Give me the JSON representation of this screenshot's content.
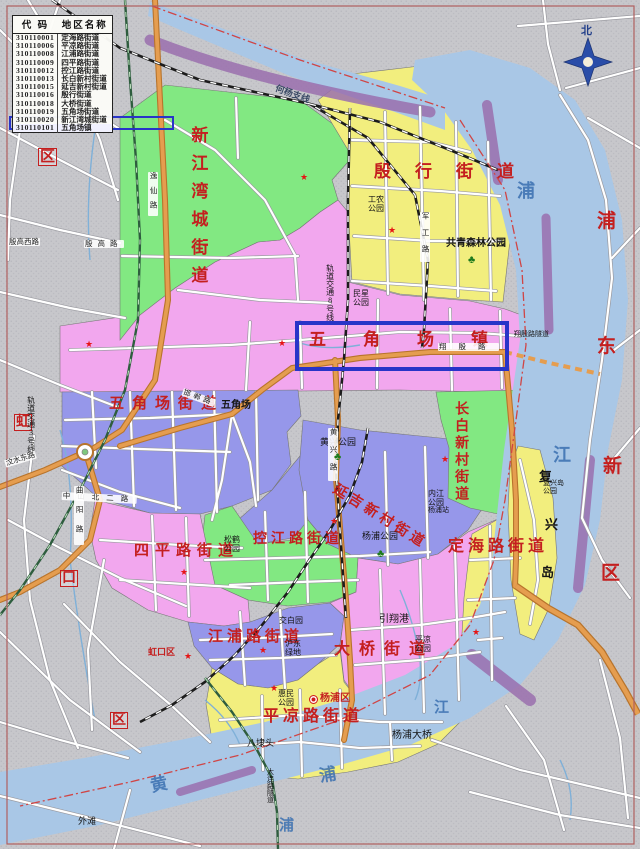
{
  "legend": {
    "headers": [
      "代 码",
      "地区名称"
    ],
    "rows": [
      [
        "310110001",
        "定海路街道"
      ],
      [
        "310110006",
        "平凉路街道"
      ],
      [
        "310110008",
        "江浦路街道"
      ],
      [
        "310110009",
        "四平路街道"
      ],
      [
        "310110012",
        "控江路街道"
      ],
      [
        "310110013",
        "长白新村街道"
      ],
      [
        "310110015",
        "延吉新村街道"
      ],
      [
        "310110016",
        "殷行街道"
      ],
      [
        "310110018",
        "大桥街道"
      ],
      [
        "310110019",
        "五角场街道"
      ],
      [
        "310110020",
        "新江湾城街道"
      ],
      [
        "310110101",
        "五角场镇"
      ]
    ],
    "highlighted_row_index": 11,
    "highlighted_row_value": "310110101 五角场镇"
  },
  "compass": {
    "north_label": "北"
  },
  "map": {
    "colors": {
      "outside_gray": "#c6c6ca",
      "region_pink": "#f2a7ee",
      "region_green": "#82e882",
      "region_yellow": "#f2ee7e",
      "region_blue": "#9697ea",
      "river_blue": "#a9c7e6",
      "orange_road": "#e59d4f",
      "purple_bank": "#9a6fae",
      "frame_red": "#b06060",
      "boundary_red": "#d04545",
      "metro_green": "#2e5d3e",
      "highlight_blue": "#2834c8",
      "red_label": "#c41f1f"
    },
    "labels": [
      {
        "n": "label-xinjiangwancheng-subdistrict",
        "t": "新江湾城街道",
        "x": 188,
        "y": 126,
        "c": "c-r",
        "fs": 17,
        "ls": 11,
        "v": true
      },
      {
        "n": "label-yinhang-subdistrict",
        "t": "殷行街道",
        "x": 374,
        "y": 163,
        "c": "c-r",
        "fs": 17,
        "ls": 24
      },
      {
        "n": "label-wujiaochang-town",
        "t": "五角场镇",
        "x": 309,
        "y": 331,
        "c": "c-r",
        "fs": 17,
        "ls": 37
      },
      {
        "n": "label-wujiaochang-subdistrict",
        "t": "五角场街道",
        "x": 109,
        "y": 396,
        "c": "c-r",
        "fs": 15,
        "ls": 8
      },
      {
        "n": "label-changbai-subdistrict",
        "t": "长白新村街道",
        "x": 453,
        "y": 401,
        "c": "c-r",
        "fs": 14,
        "ls": 3,
        "v": true
      },
      {
        "n": "label-yanji-subdistrict",
        "t": "延吉新村街道",
        "x": 338,
        "y": 482,
        "c": "c-r",
        "fs": 14,
        "ls": 4,
        "rot": 32
      },
      {
        "n": "label-kongjiang-subdistrict",
        "t": "控江路街道",
        "x": 253,
        "y": 532,
        "c": "c-r",
        "fs": 14,
        "ls": 4
      },
      {
        "n": "label-siping-subdistrict",
        "t": "四平路街道",
        "x": 134,
        "y": 543,
        "c": "c-r",
        "fs": 15,
        "ls": 6
      },
      {
        "n": "label-jiangpu-subdistrict",
        "t": "江浦路街道",
        "x": 208,
        "y": 629,
        "c": "c-r",
        "fs": 15,
        "ls": 4
      },
      {
        "n": "label-daqiao-subdistrict",
        "t": "大桥街道",
        "x": 334,
        "y": 641,
        "c": "c-r",
        "fs": 16,
        "ls": 9
      },
      {
        "n": "label-pingliang-subdistrict",
        "t": "平凉路街道",
        "x": 263,
        "y": 708,
        "c": "c-r",
        "fs": 16,
        "ls": 4
      },
      {
        "n": "label-dinghai-subdistrict",
        "t": "定海路街道",
        "x": 448,
        "y": 538,
        "c": "c-r",
        "fs": 16,
        "ls": 4
      },
      {
        "n": "label-pudong-pu",
        "t": "浦",
        "x": 597,
        "y": 212,
        "c": "c-r",
        "fs": 19
      },
      {
        "n": "label-pudong-dong",
        "t": "东",
        "x": 597,
        "y": 337,
        "c": "c-r",
        "fs": 19
      },
      {
        "n": "label-pudong-xin",
        "t": "新",
        "x": 603,
        "y": 457,
        "c": "c-r",
        "fs": 19
      },
      {
        "n": "label-pudong-qu",
        "t": "区",
        "x": 601,
        "y": 564,
        "c": "c-r",
        "fs": 19
      },
      {
        "n": "label-hongkou-hong",
        "t": "虹",
        "x": 14,
        "y": 414,
        "c": "c-r",
        "fs": 14,
        "box": true
      },
      {
        "n": "label-hongkou-kou",
        "t": "口",
        "x": 60,
        "y": 570,
        "c": "c-r",
        "fs": 14,
        "box": true
      },
      {
        "n": "label-hongkou-qu",
        "t": "区",
        "x": 110,
        "y": 712,
        "c": "c-r",
        "fs": 14,
        "box": true
      },
      {
        "n": "label-baoshan-qu",
        "t": "区",
        "x": 38,
        "y": 148,
        "c": "c-r",
        "fs": 15,
        "box": true
      },
      {
        "n": "label-hongkou-gov",
        "t": "虹口区",
        "x": 148,
        "y": 648,
        "c": "c-r",
        "fs": 9
      },
      {
        "n": "label-yangpu-gov",
        "t": "杨浦区",
        "x": 320,
        "y": 694,
        "c": "c-r",
        "fs": 10
      },
      {
        "n": "label-gongqing-forest-park",
        "t": "共青森林公园",
        "x": 446,
        "y": 239,
        "c": "c-kb",
        "fs": 10
      },
      {
        "n": "label-gongnong-park",
        "t": "工农\n公园",
        "x": 368,
        "y": 196,
        "c": "c-k",
        "fs": 8
      },
      {
        "n": "label-minxing-park",
        "t": "民星\n公园",
        "x": 353,
        "y": 290,
        "c": "c-k",
        "fs": 8
      },
      {
        "n": "label-huangxing-park",
        "t": "黄兴公园",
        "x": 320,
        "y": 438,
        "c": "c-k",
        "fs": 9
      },
      {
        "n": "label-yangpu-park",
        "t": "杨浦公园",
        "x": 362,
        "y": 532,
        "c": "c-k",
        "fs": 9
      },
      {
        "n": "label-neijiang-park",
        "t": "内江\n公园",
        "x": 428,
        "y": 490,
        "c": "c-k",
        "fs": 8
      },
      {
        "n": "label-songhe-park",
        "t": "松鹤\n公园",
        "x": 224,
        "y": 536,
        "c": "c-k",
        "fs": 8
      },
      {
        "n": "label-pingliang-park",
        "t": "平凉\n公园",
        "x": 415,
        "y": 636,
        "c": "c-k",
        "fs": 8
      },
      {
        "n": "label-huimin-park",
        "t": "惠民\n公园",
        "x": 278,
        "y": 690,
        "c": "c-k",
        "fs": 8
      },
      {
        "n": "label-yinxiang-port",
        "t": "引翔港",
        "x": 379,
        "y": 615,
        "c": "c-k",
        "fs": 10
      },
      {
        "n": "label-badaitou",
        "t": "八埭头",
        "x": 247,
        "y": 739,
        "c": "c-k",
        "fs": 9
      },
      {
        "n": "label-hudong-green",
        "t": "沪东\n绿地",
        "x": 285,
        "y": 640,
        "c": "c-k",
        "fs": 8
      },
      {
        "n": "label-jiaobai-garden",
        "t": "交白园",
        "x": 279,
        "y": 617,
        "c": "c-k",
        "fs": 8
      },
      {
        "n": "label-wujiaochang-place",
        "t": "五角场",
        "x": 221,
        "y": 401,
        "c": "c-kb",
        "fs": 10
      },
      {
        "n": "label-yangpu-bridge",
        "t": "杨浦大桥",
        "x": 392,
        "y": 731,
        "c": "c-k",
        "fs": 10
      },
      {
        "n": "label-yangpu-station",
        "t": "杨浦站",
        "x": 428,
        "y": 507,
        "c": "c-k",
        "fs": 7
      },
      {
        "n": "label-fuxing-island-park",
        "t": "复兴岛\n公园",
        "x": 543,
        "y": 480,
        "c": "c-k",
        "fs": 7
      },
      {
        "n": "label-waitan",
        "t": "外滩",
        "x": 78,
        "y": 817,
        "c": "c-k",
        "fs": 9
      },
      {
        "n": "label-fuxing-fu",
        "t": "复",
        "x": 539,
        "y": 470,
        "c": "c-kb",
        "fs": 13
      },
      {
        "n": "label-fuxing-xing",
        "t": "兴",
        "x": 545,
        "y": 518,
        "c": "c-kb",
        "fs": 13
      },
      {
        "n": "label-fuxing-dao",
        "t": "岛",
        "x": 541,
        "y": 566,
        "c": "c-kb",
        "fs": 13
      },
      {
        "n": "label-xiangyin-tunnel",
        "t": "翔殷路隧道",
        "x": 514,
        "y": 331,
        "c": "c-k",
        "fs": 7
      },
      {
        "n": "label-heyang-rail-branch",
        "t": "何杨支线",
        "x": 277,
        "y": 84,
        "c": "c-rail",
        "fs": 9,
        "rot": 20
      },
      {
        "n": "label-metro-line8",
        "t": "轨道交通8号线",
        "x": 325,
        "y": 264,
        "c": "c-k",
        "fs": 8,
        "v": true
      },
      {
        "n": "label-metro-line3",
        "t": "轨道交通3号线",
        "x": 26,
        "y": 396,
        "c": "c-k",
        "fs": 8,
        "v": true
      },
      {
        "n": "label-dalian-rd-tunnel",
        "t": "大连路隧道",
        "x": 266,
        "y": 768,
        "c": "c-k",
        "fs": 7,
        "v": true
      },
      {
        "n": "label-river-pu-north",
        "t": "浦",
        "x": 517,
        "y": 182,
        "c": "c-b",
        "fs": 18
      },
      {
        "n": "label-river-jiang-east",
        "t": "江",
        "x": 553,
        "y": 446,
        "c": "c-b",
        "fs": 18
      },
      {
        "n": "label-river-huang",
        "t": "黄",
        "x": 149,
        "y": 778,
        "c": "c-b",
        "fs": 17,
        "rot": -12
      },
      {
        "n": "label-river-pu-south",
        "t": "浦",
        "x": 318,
        "y": 768,
        "c": "c-b",
        "fs": 17,
        "rot": -10
      },
      {
        "n": "label-river-pu-sw",
        "t": "浦",
        "x": 279,
        "y": 818,
        "c": "c-b",
        "fs": 15
      },
      {
        "n": "label-river-jiang-south",
        "t": "江",
        "x": 434,
        "y": 700,
        "c": "c-b",
        "fs": 15
      },
      {
        "n": "chip-wenshuidong-rd",
        "t": "汶水东路",
        "x": 4,
        "y": 460,
        "c": "c-chip",
        "fs": 7.5,
        "rot": -17
      },
      {
        "n": "chip-yingaoxi-rd",
        "t": "殷高西路",
        "x": 8,
        "y": 238,
        "c": "c-chip",
        "fs": 7.5
      },
      {
        "n": "chip-yingao-rd",
        "t": "殷高路",
        "x": 84,
        "y": 240,
        "c": "c-chip",
        "fs": 7.5,
        "ls": 5
      },
      {
        "n": "chip-zhongshanbeier-rd",
        "t": "中山北二路",
        "x": 62,
        "y": 492,
        "c": "c-chip",
        "fs": 7.5,
        "ls": 7,
        "rot": 3
      },
      {
        "n": "chip-xiangyin-rd",
        "t": "翔殷路",
        "x": 438,
        "y": 343,
        "c": "c-chip",
        "fs": 7.5,
        "ls": 12
      },
      {
        "n": "chip-handan-rd",
        "t": "邯郸路",
        "x": 184,
        "y": 388,
        "c": "c-chip",
        "fs": 7.5,
        "rot": 20,
        "ls": 3
      },
      {
        "n": "chip-jungong-rd",
        "t": "军工路",
        "x": 420,
        "y": 212,
        "c": "c-chip",
        "fs": 7.5,
        "v": true,
        "ls": 9
      },
      {
        "n": "chip-yixian-rd",
        "t": "逸仙路",
        "x": 148,
        "y": 172,
        "c": "c-chip",
        "fs": 7.5,
        "v": true,
        "ls": 7
      },
      {
        "n": "chip-quyang-rd",
        "t": "曲阳路",
        "x": 74,
        "y": 486,
        "c": "c-chip",
        "fs": 7.5,
        "v": true,
        "ls": 12
      },
      {
        "n": "chip-huangxing-rd",
        "t": "黄兴路",
        "x": 328,
        "y": 428,
        "c": "c-chip",
        "fs": 7.5,
        "v": true,
        "ls": 10
      },
      {
        "n": "compass-north-label",
        "t": "北",
        "x": 581,
        "y": 26,
        "c": "c-comp",
        "fs": 11
      }
    ],
    "stars": [
      [
        300,
        173
      ],
      [
        388,
        226
      ],
      [
        85,
        340
      ],
      [
        278,
        339
      ],
      [
        441,
        455
      ],
      [
        330,
        517
      ],
      [
        180,
        568
      ],
      [
        472,
        628
      ],
      [
        259,
        646
      ],
      [
        270,
        684
      ],
      [
        184,
        652
      ]
    ],
    "icons": [
      {
        "type": "tree-icon",
        "x": 468,
        "y": 255
      },
      {
        "type": "tree-icon",
        "x": 334,
        "y": 452
      },
      {
        "type": "tree-icon",
        "x": 377,
        "y": 549
      },
      {
        "type": "government-icon",
        "x": 309,
        "y": 695
      }
    ],
    "highlight_box_text": "五角场镇"
  }
}
